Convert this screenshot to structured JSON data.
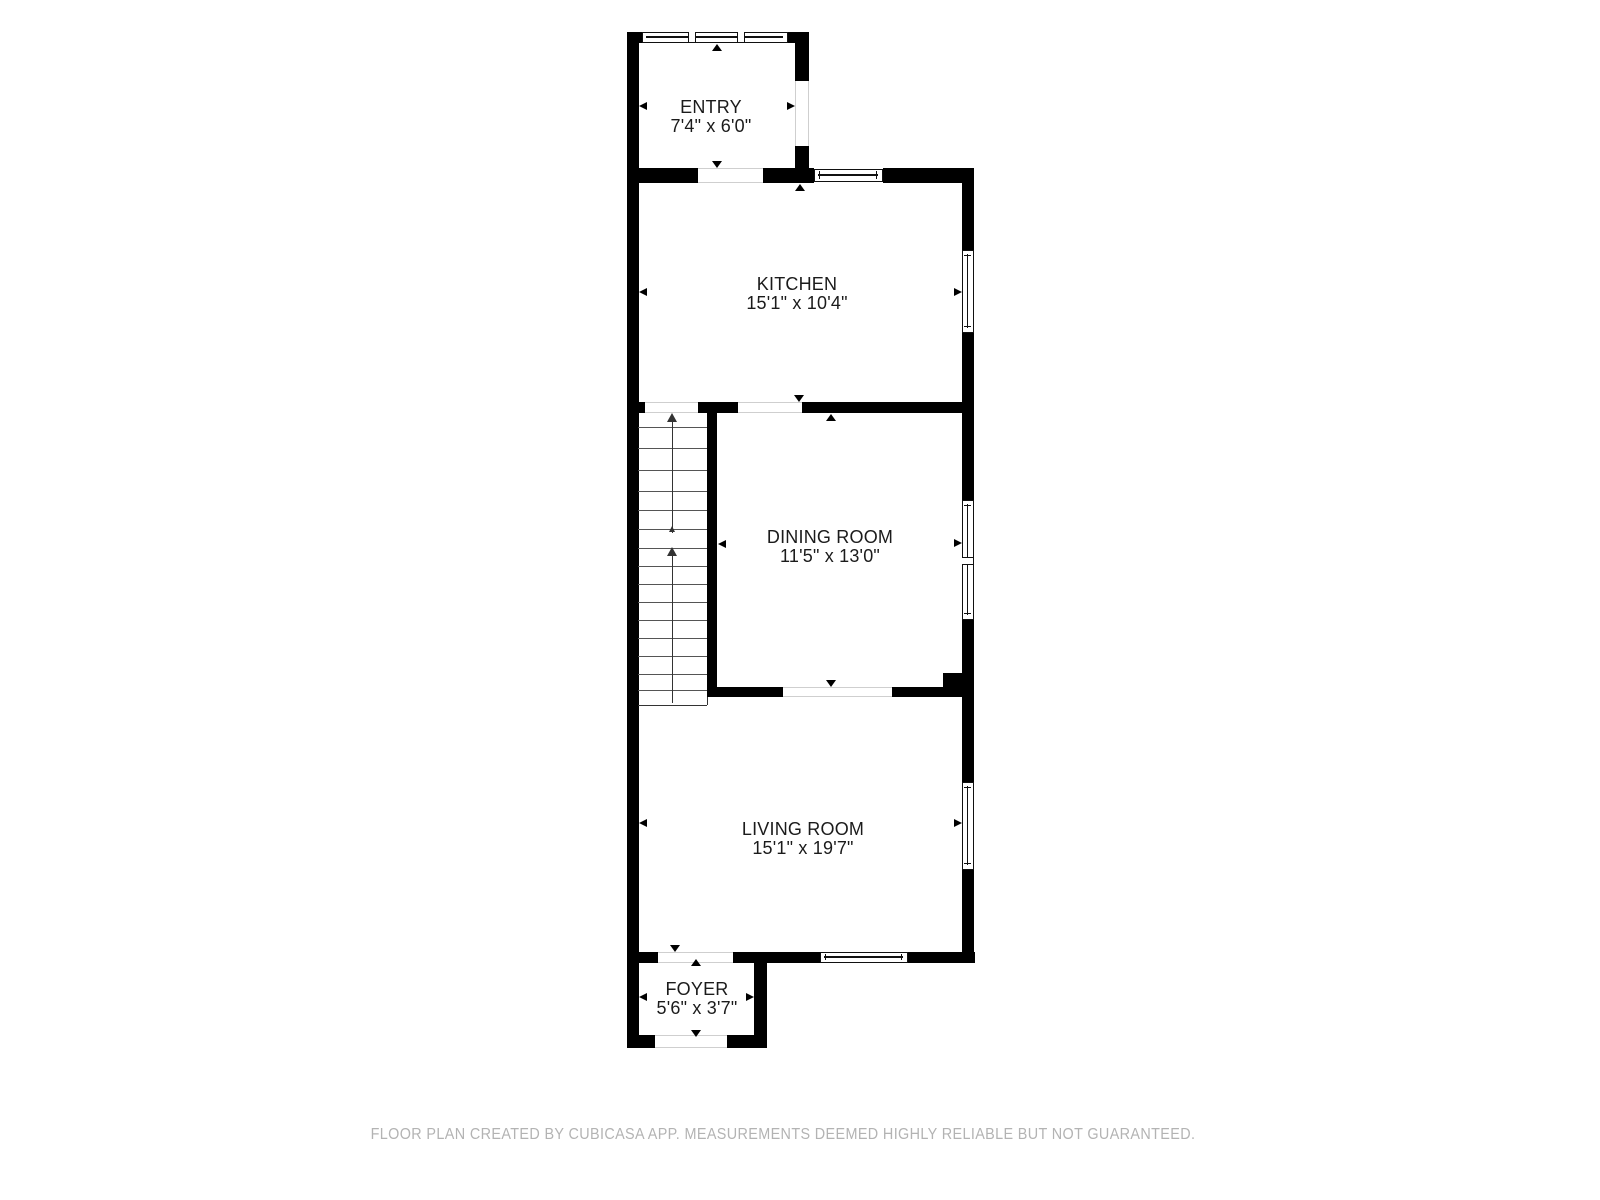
{
  "floorplan": {
    "colors": {
      "wall": "#000000",
      "label": "#1b1b1b",
      "footer": "#b3b3b3",
      "threshold": "#cfcfcf",
      "tread": "#555555",
      "stair_arrow": "#333333",
      "background": "#ffffff"
    },
    "rooms": [
      {
        "id": "entry",
        "name": "ENTRY",
        "dims": "7'4\" x 6'0\"",
        "cx": 711,
        "cy": 117
      },
      {
        "id": "kitchen",
        "name": "KITCHEN",
        "dims": "15'1\" x 10'4\"",
        "cx": 797,
        "cy": 294
      },
      {
        "id": "dining-room",
        "name": "DINING ROOM",
        "dims": "11'5\" x 13'0\"",
        "cx": 830,
        "cy": 547
      },
      {
        "id": "living-room",
        "name": "LIVING ROOM",
        "dims": "15'1\" x 19'7\"",
        "cx": 803,
        "cy": 839
      },
      {
        "id": "foyer",
        "name": "FOYER",
        "dims": "5'6\" x 3'7\"",
        "cx": 697,
        "cy": 999
      }
    ],
    "walls": [
      {
        "x": 627,
        "y": 32,
        "w": 12,
        "h": 1016
      },
      {
        "x": 627,
        "y": 32,
        "w": 15,
        "h": 11
      },
      {
        "x": 788,
        "y": 32,
        "w": 21,
        "h": 11
      },
      {
        "x": 795,
        "y": 32,
        "w": 14,
        "h": 49
      },
      {
        "x": 795,
        "y": 146,
        "w": 14,
        "h": 37
      },
      {
        "x": 627,
        "y": 168,
        "w": 71,
        "h": 15
      },
      {
        "x": 763,
        "y": 168,
        "w": 51,
        "h": 15
      },
      {
        "x": 883,
        "y": 168,
        "w": 91,
        "h": 15
      },
      {
        "x": 962,
        "y": 168,
        "w": 12,
        "h": 795
      },
      {
        "x": 627,
        "y": 402,
        "w": 18,
        "h": 11
      },
      {
        "x": 698,
        "y": 402,
        "w": 40,
        "h": 11
      },
      {
        "x": 802,
        "y": 402,
        "w": 172,
        "h": 11
      },
      {
        "x": 707,
        "y": 402,
        "w": 10,
        "h": 295
      },
      {
        "x": 717,
        "y": 687,
        "w": 66,
        "h": 10
      },
      {
        "x": 892,
        "y": 687,
        "w": 82,
        "h": 10
      },
      {
        "x": 943,
        "y": 673,
        "w": 31,
        "h": 24
      },
      {
        "x": 627,
        "y": 952,
        "w": 31,
        "h": 11
      },
      {
        "x": 733,
        "y": 952,
        "w": 87,
        "h": 11
      },
      {
        "x": 908,
        "y": 952,
        "w": 67,
        "h": 11
      },
      {
        "x": 754,
        "y": 952,
        "w": 13,
        "h": 96
      },
      {
        "x": 627,
        "y": 1035,
        "w": 28,
        "h": 13
      },
      {
        "x": 727,
        "y": 1035,
        "w": 40,
        "h": 13
      }
    ],
    "openings": [
      {
        "x": 795,
        "y": 81,
        "w": 14,
        "h": 65,
        "axis": "v"
      },
      {
        "x": 698,
        "y": 168,
        "w": 65,
        "h": 15,
        "axis": "h"
      },
      {
        "x": 645,
        "y": 402,
        "w": 53,
        "h": 11,
        "axis": "h"
      },
      {
        "x": 738,
        "y": 402,
        "w": 64,
        "h": 11,
        "axis": "h"
      },
      {
        "x": 783,
        "y": 687,
        "w": 109,
        "h": 10,
        "axis": "h"
      },
      {
        "x": 658,
        "y": 952,
        "w": 75,
        "h": 11,
        "axis": "h"
      },
      {
        "x": 655,
        "y": 1035,
        "w": 72,
        "h": 13,
        "axis": "h"
      }
    ],
    "windows": [
      {
        "x": 642,
        "y": 32,
        "w": 146,
        "h": 11,
        "axis": "h",
        "dividers": [
          691,
          740
        ],
        "caps": false
      },
      {
        "x": 814,
        "y": 169,
        "w": 69,
        "h": 13,
        "axis": "h",
        "dividers": [],
        "caps": true
      },
      {
        "x": 962,
        "y": 250,
        "w": 12,
        "h": 83,
        "axis": "v",
        "dividers": [],
        "caps": true
      },
      {
        "x": 962,
        "y": 500,
        "w": 12,
        "h": 120,
        "axis": "v",
        "dividers": [
          560
        ],
        "caps": true
      },
      {
        "x": 962,
        "y": 782,
        "w": 12,
        "h": 88,
        "axis": "v",
        "dividers": [],
        "caps": true
      },
      {
        "x": 820,
        "y": 952,
        "w": 88,
        "h": 11,
        "axis": "h",
        "dividers": [],
        "caps": true
      }
    ],
    "measure_arrows": [
      {
        "id": "entry-top",
        "x": 717,
        "y": 44,
        "dir": "up"
      },
      {
        "id": "entry-bottom",
        "x": 717,
        "y": 168,
        "dir": "down"
      },
      {
        "id": "entry-left",
        "x": 639,
        "y": 106,
        "dir": "left"
      },
      {
        "id": "entry-right",
        "x": 795,
        "y": 106,
        "dir": "right"
      },
      {
        "id": "kitchen-top",
        "x": 800,
        "y": 184,
        "dir": "up"
      },
      {
        "id": "kitchen-bottom",
        "x": 799,
        "y": 402,
        "dir": "down"
      },
      {
        "id": "kitchen-left",
        "x": 639,
        "y": 292,
        "dir": "left"
      },
      {
        "id": "kitchen-right",
        "x": 962,
        "y": 292,
        "dir": "right"
      },
      {
        "id": "dining-top",
        "x": 831,
        "y": 414,
        "dir": "up"
      },
      {
        "id": "dining-bottom",
        "x": 831,
        "y": 687,
        "dir": "down"
      },
      {
        "id": "dining-left",
        "x": 718,
        "y": 544,
        "dir": "left"
      },
      {
        "id": "dining-right",
        "x": 962,
        "y": 543,
        "dir": "right"
      },
      {
        "id": "living-left",
        "x": 639,
        "y": 823,
        "dir": "left"
      },
      {
        "id": "living-right",
        "x": 962,
        "y": 823,
        "dir": "right"
      },
      {
        "id": "living-bottom",
        "x": 675,
        "y": 952,
        "dir": "down"
      },
      {
        "id": "foyer-top",
        "x": 696,
        "y": 959,
        "dir": "up"
      },
      {
        "id": "foyer-bottom",
        "x": 696,
        "y": 1037,
        "dir": "down"
      },
      {
        "id": "foyer-left",
        "x": 639,
        "y": 997,
        "dir": "left"
      },
      {
        "id": "foyer-right",
        "x": 754,
        "y": 997,
        "dir": "right"
      }
    ],
    "stairs": {
      "x": 638,
      "w": 69,
      "top": 413,
      "bottom": 705,
      "treads_y": [
        427,
        448,
        470,
        491,
        510,
        529,
        548,
        566,
        584,
        602,
        620,
        638,
        656,
        674,
        690
      ],
      "rail_x": 672,
      "flights": [
        {
          "line_top": 422,
          "line_bottom": 528,
          "tip": 413,
          "size": "big"
        },
        {
          "line_top": 556,
          "line_bottom": 703,
          "tip": 547,
          "size": "big"
        },
        {
          "line_top": 532,
          "line_bottom": 533,
          "tip": 526,
          "size": "small"
        }
      ]
    },
    "footer": {
      "text": "FLOOR PLAN CREATED BY CUBICASA APP. MEASUREMENTS DEEMED HIGHLY RELIABLE BUT NOT GUARANTEED.",
      "cx": 783,
      "cy": 1135
    }
  }
}
